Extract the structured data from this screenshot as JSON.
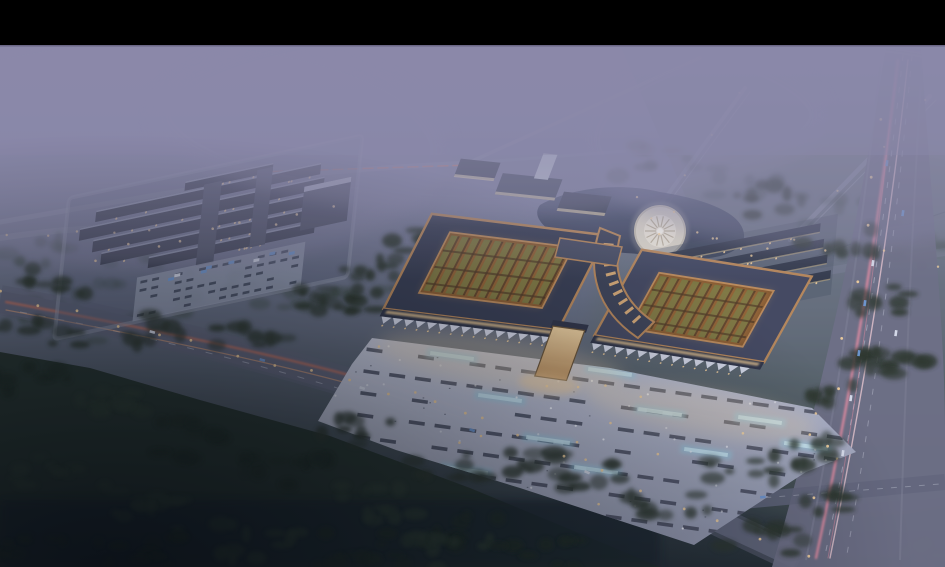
{
  "scene": {
    "type": "aerial-architectural-rendering",
    "time_of_day": "dusk",
    "regions": [
      "letterbox-bar",
      "hazy-purple-sky",
      "distant-diagonal-roads",
      "misty-treeline",
      "left-market-complex",
      "left-parking-lot",
      "central-office-buildings",
      "pond",
      "circular-fountain-plaza",
      "east-row-buildings",
      "main-hall-west",
      "main-hall-east",
      "entrance-gate",
      "front-parking-plaza",
      "main-access-road",
      "riverside-highway",
      "forest-foreground",
      "vehicle-light-trails"
    ]
  },
  "palette": {
    "letterbox": "#000000",
    "sky_top": "#908ead",
    "sky_mid": "#7d819e",
    "haze_lavender": "#8d8bab",
    "field_green": "#5f6d66",
    "forest_green": "#2b3a2e",
    "forest_dark": "#1b2420",
    "ground_dark": "#222c33",
    "road_grey": "#62667c",
    "road_light": "#979cb2",
    "highway_grey": "#6e7086",
    "trail_red": "#ff7a50",
    "trail_pink": "#ff93a8",
    "trail_white": "#ffd7de",
    "roof_dark": "#373d52",
    "roof_light": "#424860",
    "roof_copper": "#b9895a",
    "courtyard_warm": "#7c5128",
    "courtyard_green": "#64703a",
    "facade_light": "#dfe4f2",
    "plaza_light": "#c9cde0",
    "plaza_mid": "#a9aec4",
    "glow_blue": "#9ad2ea",
    "light_warm": "#ffd9a0",
    "light_cool": "#f4f7ff",
    "water": "#3d4660",
    "fountain_white": "#e9e3d4",
    "car_white": "#dfe5f2",
    "car_blue": "#6f9bd8"
  }
}
